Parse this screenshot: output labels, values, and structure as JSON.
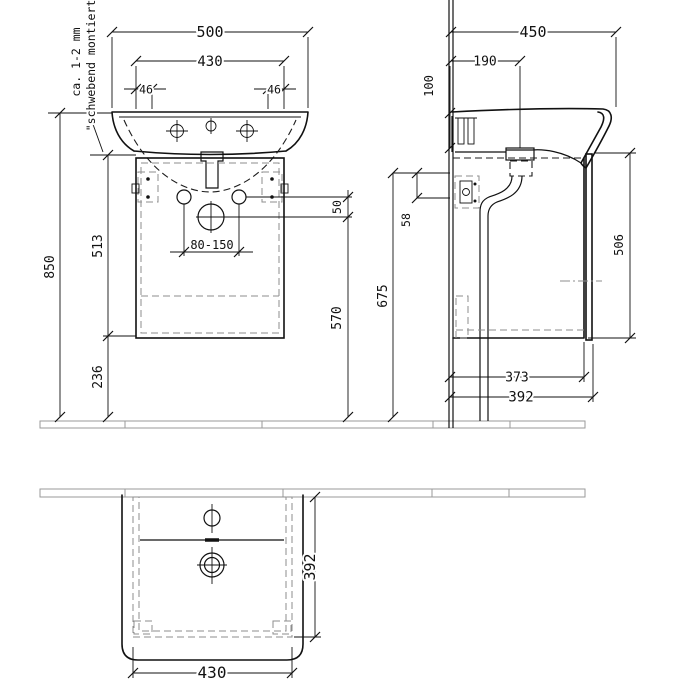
{
  "note": {
    "line1": "ca. 1-2 mm",
    "line2": "\"schwebend montiert\""
  },
  "dims": {
    "front_width_total": "500",
    "front_width_cabinet": "430",
    "front_offset_left": "46",
    "front_offset_right": "46",
    "front_height_total": "850",
    "front_height_cabinet": "513",
    "front_height_floor": "236",
    "tap_connection_range": "80-150",
    "supply_drain_gap": "50",
    "drain_height": "570",
    "bracket_height": "675",
    "bracket_span": "58",
    "side_depth_total": "450",
    "side_drain_depth": "190",
    "side_basin_height": "100",
    "side_door_height": "506",
    "side_cabinet_depth": "373",
    "side_depth_with_door": "392",
    "plan_depth": "392",
    "plan_width": "430"
  }
}
